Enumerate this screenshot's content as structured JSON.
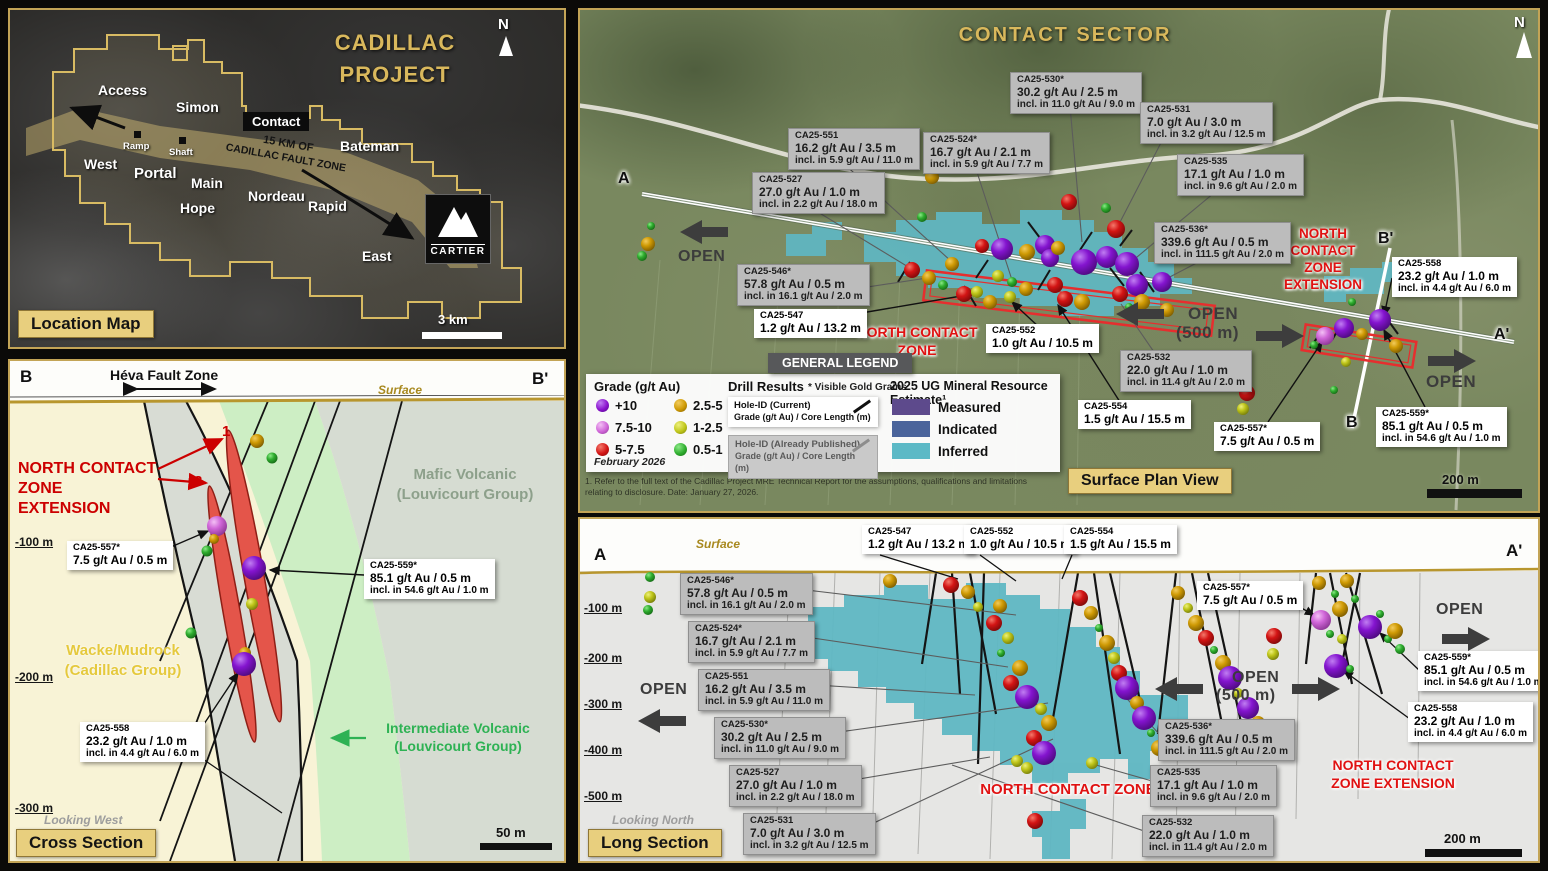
{
  "location_map": {
    "panel_label": "Location Map",
    "title1": "CADILLAC",
    "title2": "PROJECT",
    "north": "N",
    "scale": "3 km",
    "logo": "CARTIER",
    "fault1": "15 KM OF",
    "fault2": "CADILLAC FAULT ZONE",
    "contact": "Contact",
    "zones": {
      "access": "Access",
      "simon": "Simon",
      "west": "West",
      "ramp": "Ramp",
      "shaft": "Shaft",
      "portal": "Portal",
      "main": "Main",
      "hope": "Hope",
      "nordeau": "Nordeau",
      "bateman": "Bateman",
      "rapid": "Rapid",
      "east": "East"
    }
  },
  "plan": {
    "title": "CONTACT SECTOR",
    "panel_label": "Surface Plan View",
    "north": "N",
    "scale": "200 m",
    "a": "A",
    "a_prime": "A'",
    "b": "B",
    "b_prime": "B'",
    "open_left": "OPEN",
    "open_right": "OPEN",
    "open_mid1": "OPEN",
    "open_mid2": "(500 m)",
    "ncz1": "NORTH CONTACT",
    "ncz2": "ZONE",
    "ncze1": "NORTH",
    "ncze2": "CONTACT",
    "ncze3": "ZONE",
    "ncze4": "EXTENSION",
    "labels": [
      {
        "id": "CA25-530*",
        "l1": "30.2 g/t Au / 2.5 m",
        "l2": "incl. in 11.0 g/t Au / 9.0 m"
      },
      {
        "id": "CA25-531",
        "l1": "7.0 g/t Au / 3.0 m",
        "l2": "incl. in 3.2 g/t Au / 12.5 m"
      },
      {
        "id": "CA25-551",
        "l1": "16.2 g/t Au / 3.5 m",
        "l2": "incl. in 5.9 g/t Au / 11.0 m"
      },
      {
        "id": "CA25-524*",
        "l1": "16.7 g/t Au / 2.1 m",
        "l2": "incl. in 5.9 g/t Au / 7.7 m"
      },
      {
        "id": "CA25-535",
        "l1": "17.1 g/t Au / 1.0 m",
        "l2": "incl. in 9.6 g/t Au / 2.0 m"
      },
      {
        "id": "CA25-527",
        "l1": "27.0 g/t Au / 1.0 m",
        "l2": "incl. in 2.2 g/t Au / 18.0 m"
      },
      {
        "id": "CA25-536*",
        "l1": "339.6 g/t Au / 0.5 m",
        "l2": "incl. in 111.5 g/t Au / 2.0 m"
      },
      {
        "id": "CA25-546*",
        "l1": "57.8 g/t Au / 0.5 m",
        "l2": "incl. in 16.1 g/t Au / 2.0 m"
      },
      {
        "id": "CA25-547",
        "l1": "1.2 g/t Au / 13.2 m"
      },
      {
        "id": "CA25-552",
        "l1": "1.0 g/t Au / 10.5 m"
      },
      {
        "id": "CA25-532",
        "l1": "22.0 g/t Au / 1.0 m",
        "l2": "incl. in 11.4 g/t Au / 2.0 m"
      },
      {
        "id": "CA25-554",
        "l1": "1.5 g/t Au / 15.5 m"
      },
      {
        "id": "CA25-557*",
        "l1": "7.5 g/t Au / 0.5 m"
      },
      {
        "id": "CA25-558",
        "l1": "23.2 g/t Au / 1.0 m",
        "l2": "incl. in 4.4 g/t Au / 6.0 m"
      },
      {
        "id": "CA25-559*",
        "l1": "85.1 g/t Au / 0.5 m",
        "l2": "incl. in 54.6 g/t Au / 1.0 m"
      }
    ]
  },
  "legend": {
    "header": "GENERAL LEGEND",
    "grade_title": "Grade (g/t Au)",
    "grades": [
      {
        "label": "+10",
        "color": "#8a12cd"
      },
      {
        "label": "7.5-10",
        "color": "#d066d8"
      },
      {
        "label": "5-7.5",
        "color": "#d31414"
      },
      {
        "label": "2.5-5",
        "color": "#cf9a04"
      },
      {
        "label": "1-2.5",
        "color": "#bfc61a"
      },
      {
        "label": "0.5-1",
        "color": "#2fae2f"
      }
    ],
    "date": "February 2026",
    "drill_title": "Drill Results",
    "vgg_note": "* Visible Gold Grains",
    "current1": "Hole-ID (Current)",
    "current2": "Grade (g/t Au) / Core Length (m)",
    "published1": "Hole-ID (Already Published)",
    "published2": "Grade (g/t Au) / Core Length (m)",
    "mre_title": "2025 UG Mineral Resource Estimate¹",
    "mre": [
      {
        "label": "Measured",
        "color": "#5d4a8c"
      },
      {
        "label": "Indicated",
        "color": "#4a649b"
      },
      {
        "label": "Inferred",
        "color": "#5cb9c6"
      }
    ],
    "footnote": "1. Refer to the full text of the Cadillac Project MRE Technical Report for the assumptions, qualifications and limitations relating to disclosure. Date: January 27, 2026."
  },
  "cross": {
    "panel_label": "Cross Section",
    "looking": "Looking West",
    "b": "B",
    "b_prime": "B'",
    "heva": "Héva Fault Zone",
    "surface": "Surface",
    "ncze1": "NORTH CONTACT",
    "ncze2": "ZONE EXTENSION",
    "lens1": "1",
    "lens3": "3",
    "depth1": "-100 m",
    "depth2": "-200 m",
    "depth3": "-300 m",
    "scale": "50 m",
    "mafic1": "Mafic Volcanic",
    "mafic2": "(Louvicourt Group)",
    "wacke1": "Wacke/Mudrock",
    "wacke2": "(Cadillac Group)",
    "inter1": "Intermediate Volcanic",
    "inter2": "(Louvicourt Group)",
    "labels": [
      {
        "id": "CA25-557*",
        "l1": "7.5 g/t Au / 0.5 m"
      },
      {
        "id": "CA25-559*",
        "l1": "85.1 g/t Au / 0.5 m",
        "l2": "incl. in 54.6 g/t Au / 1.0 m"
      },
      {
        "id": "CA25-558",
        "l1": "23.2 g/t Au / 1.0 m",
        "l2": "incl. in 4.4 g/t Au / 6.0 m"
      }
    ]
  },
  "long": {
    "panel_label": "Long Section",
    "looking": "Looking North",
    "a": "A",
    "a_prime": "A'",
    "surface": "Surface",
    "depth1": "-100 m",
    "depth2": "-200 m",
    "depth3": "-300 m",
    "depth4": "-400 m",
    "depth5": "-500 m",
    "scale": "200 m",
    "open_left": "OPEN",
    "open_right": "OPEN",
    "open_mid1": "OPEN",
    "open_mid2": "(500 m)",
    "ncz": "NORTH CONTACT ZONE",
    "ncze1": "NORTH CONTACT",
    "ncze2": "ZONE EXTENSION",
    "labels": [
      {
        "id": "CA25-547",
        "l1": "1.2 g/t Au / 13.2 m"
      },
      {
        "id": "CA25-552",
        "l1": "1.0 g/t Au / 10.5 m"
      },
      {
        "id": "CA25-554",
        "l1": "1.5 g/t Au / 15.5 m"
      },
      {
        "id": "CA25-546*",
        "l1": "57.8 g/t Au / 0.5 m",
        "l2": "incl. in 16.1 g/t Au / 2.0 m"
      },
      {
        "id": "CA25-524*",
        "l1": "16.7 g/t Au / 2.1 m",
        "l2": "incl. in 5.9 g/t Au / 7.7 m"
      },
      {
        "id": "CA25-551",
        "l1": "16.2 g/t Au / 3.5 m",
        "l2": "incl. in 5.9 g/t Au / 11.0 m"
      },
      {
        "id": "CA25-530*",
        "l1": "30.2 g/t Au / 2.5 m",
        "l2": "incl. in 11.0 g/t Au / 9.0 m"
      },
      {
        "id": "CA25-527",
        "l1": "27.0 g/t Au / 1.0 m",
        "l2": "incl. in 2.2 g/t Au / 18.0 m"
      },
      {
        "id": "CA25-531",
        "l1": "7.0 g/t Au / 3.0 m",
        "l2": "incl. in 3.2 g/t Au / 12.5 m"
      },
      {
        "id": "CA25-557*",
        "l1": "7.5 g/t Au / 0.5 m"
      },
      {
        "id": "CA25-559*",
        "l1": "85.1 g/t Au / 0.5 m",
        "l2": "incl. in 54.6 g/t Au / 1.0 m"
      },
      {
        "id": "CA25-558",
        "l1": "23.2 g/t Au / 1.0 m",
        "l2": "incl. in 4.4 g/t Au / 6.0 m"
      },
      {
        "id": "CA25-536*",
        "l1": "339.6 g/t Au / 0.5 m",
        "l2": "incl. in 111.5 g/t Au / 2.0 m"
      },
      {
        "id": "CA25-535",
        "l1": "17.1 g/t Au / 1.0 m",
        "l2": "incl. in 9.6 g/t Au / 2.0 m"
      },
      {
        "id": "CA25-532",
        "l1": "22.0 g/t Au / 1.0 m",
        "l2": "incl. in 11.4 g/t Au / 2.0 m"
      }
    ]
  }
}
